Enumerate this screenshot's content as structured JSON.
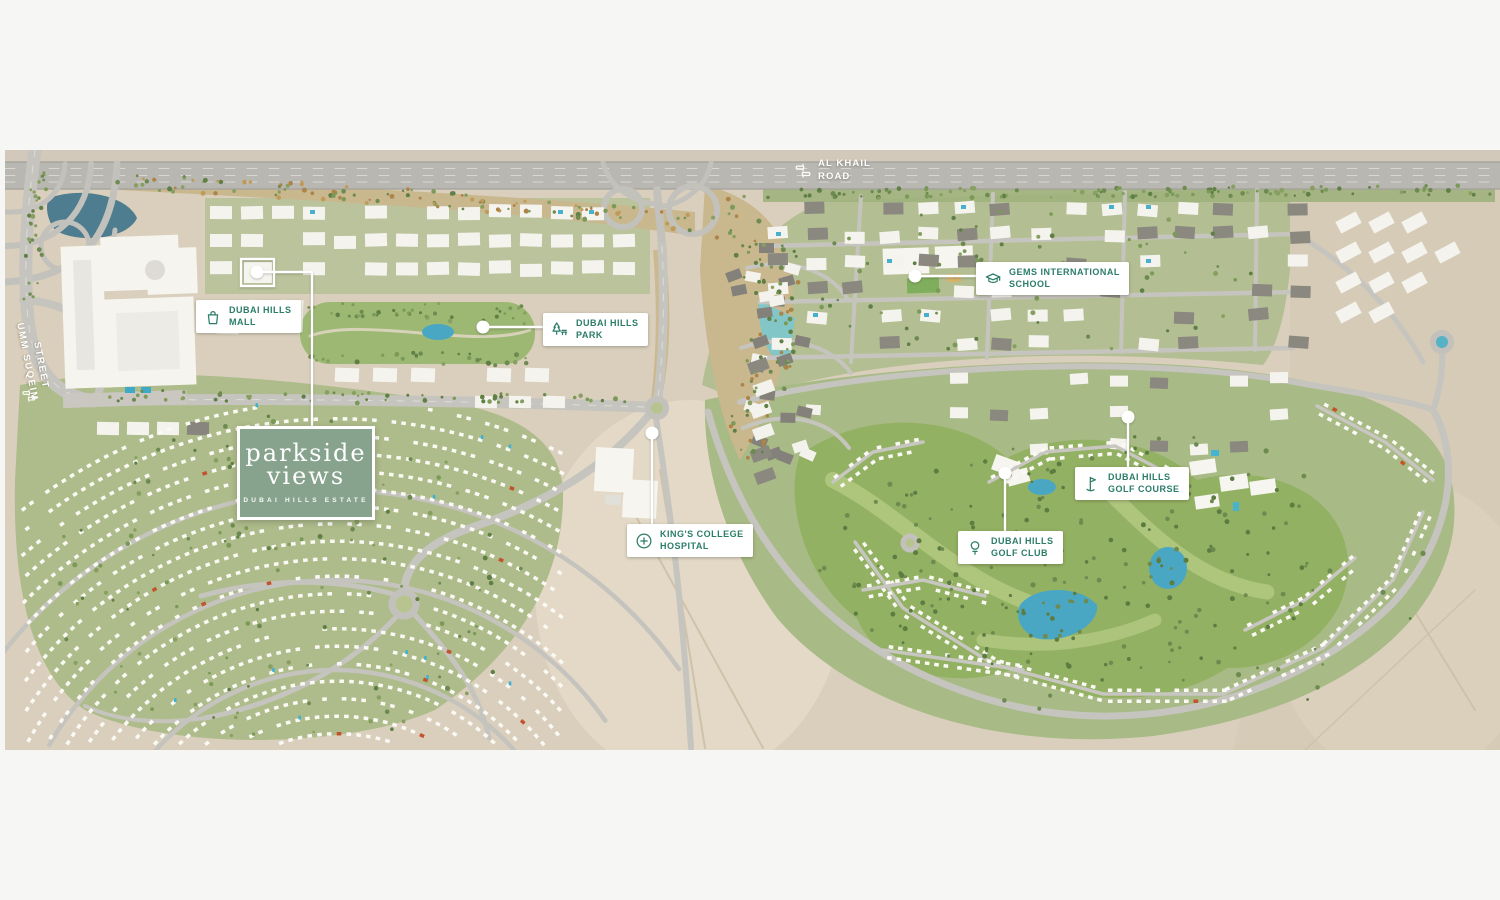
{
  "map": {
    "title": "Dubai Hills Estate masterplan",
    "colors": {
      "accent": "#2b7d68",
      "label_bg": "#ffffff",
      "leader": "#ffffff",
      "brand_bg": "#87a28d",
      "sand": "#d9cfbc",
      "community_green": "#aebc8b",
      "golf_green": "#93b162",
      "water": "#4aa7c4"
    },
    "labels": [
      {
        "id": "mall",
        "icon": "shopping-bag-icon",
        "line1": "DUBAI HILLS",
        "line2": "MALL"
      },
      {
        "id": "park",
        "icon": "park-tree-icon",
        "line1": "DUBAI HILLS",
        "line2": "PARK"
      },
      {
        "id": "gems",
        "icon": "graduation-cap-icon",
        "line1": "GEMS INTERNATIONAL",
        "line2": "SCHOOL"
      },
      {
        "id": "golf-course",
        "icon": "golf-flag-icon",
        "line1": "DUBAI HILLS",
        "line2": "GOLF COURSE"
      },
      {
        "id": "golf-club",
        "icon": "golf-ball-icon",
        "line1": "DUBAI HILLS",
        "line2": "GOLF CLUB"
      },
      {
        "id": "hospital",
        "icon": "medical-cross-icon",
        "line1": "KING'S COLLEGE",
        "line2": "HOSPITAL"
      }
    ],
    "roads": [
      {
        "id": "al-khail",
        "icon": "highway-icon",
        "line1": "AL KHAIL",
        "line2": "ROAD"
      },
      {
        "id": "umm-suqeim",
        "icon": "highway-icon",
        "line1": "UMM SUQEIM",
        "line2": "STREET"
      }
    ],
    "brand": {
      "name_line1": "parkside",
      "name_line2": "views",
      "subtitle": "DUBAI HILLS ESTATE"
    }
  }
}
